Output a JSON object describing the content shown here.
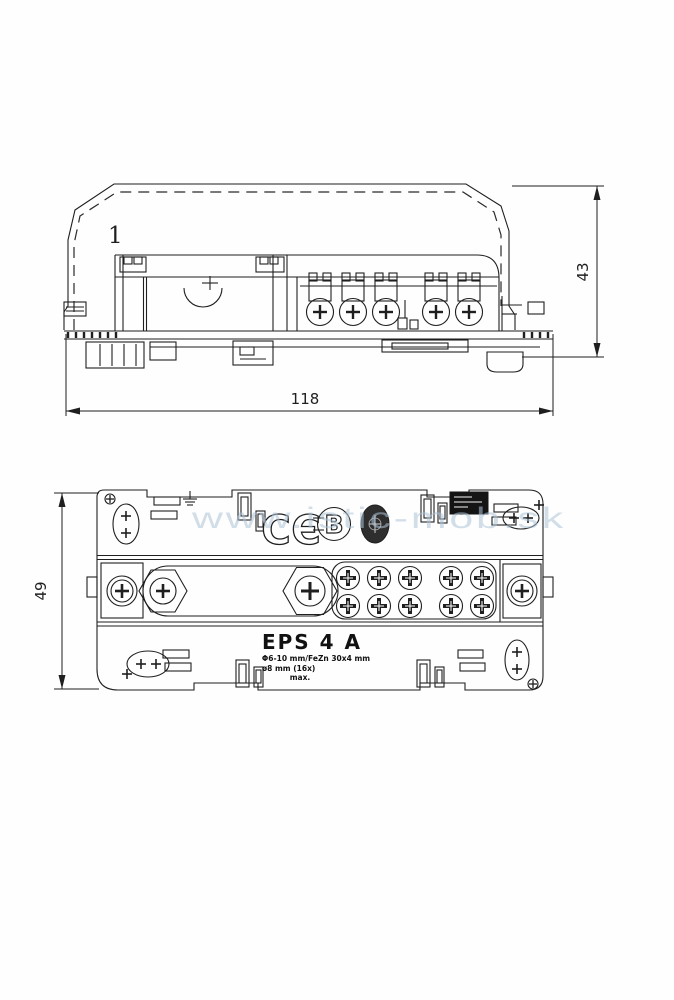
{
  "watermark": {
    "text": "www.istic-mob.sk",
    "color": "#aec4d7"
  },
  "front_view": {
    "part_label": "1",
    "dim_width": "118",
    "dim_height": "43"
  },
  "plan_view": {
    "dim_depth": "49",
    "product_name": "EPS 4 A",
    "spec_line1": "Φ6-10 mm/FeZn 30x4 mm",
    "spec_line2": "ø8 mm (16x)",
    "spec_line3": "max.",
    "ce_letter_c": "C",
    "ce_letter_e": "Є",
    "cert_mark_letter": "B"
  },
  "colors": {
    "line": "#1f1f1f",
    "background": "#fefefe"
  }
}
